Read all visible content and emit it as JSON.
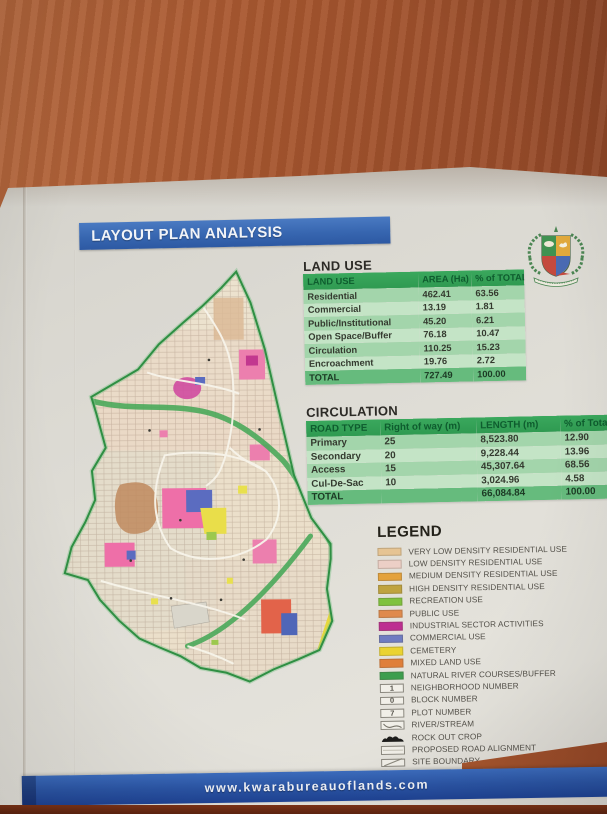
{
  "page": {
    "title_bar": {
      "label": "LAYOUT PLAN ANALYSIS",
      "bg": "#3766b0"
    },
    "footer": {
      "url": "www.kwarabureauoflands.com",
      "bg": "#2b55a5"
    },
    "table_header_green": "#34a356",
    "table_total_green": "#66bb7d"
  },
  "land_use": {
    "heading": "LAND USE",
    "columns": [
      "LAND USE",
      "AREA (Ha)",
      "% of TOTAL"
    ],
    "rows": [
      [
        "Residential",
        "462.41",
        "63.56"
      ],
      [
        "Commercial",
        "13.19",
        "1.81"
      ],
      [
        "Public/Institutional",
        "45.20",
        "6.21"
      ],
      [
        "Open Space/Buffer",
        "76.18",
        "10.47"
      ],
      [
        "Circulation",
        "110.25",
        "15.23"
      ],
      [
        "Encroachment",
        "19.76",
        "2.72"
      ],
      [
        "TOTAL",
        "727.49",
        "100.00"
      ]
    ]
  },
  "circulation": {
    "heading": "CIRCULATION",
    "columns": [
      "ROAD TYPE",
      "Right of way (m)",
      "LENGTH (m)",
      "% of Total Length"
    ],
    "rows": [
      [
        "Primary",
        "25",
        "8,523.80",
        "12.90"
      ],
      [
        "Secondary",
        "20",
        "9,228.44",
        "13.96"
      ],
      [
        "Access",
        "15",
        "45,307.64",
        "68.56"
      ],
      [
        "Cul-De-Sac",
        "10",
        "3,024.96",
        "4.58"
      ],
      [
        "TOTAL",
        "",
        "66,084.84",
        "100.00"
      ]
    ]
  },
  "legend": {
    "heading": "LEGEND",
    "items": [
      {
        "label": "VERY LOW DENSITY RESIDENTIAL USE",
        "type": "swatch",
        "color": "#e6c493",
        "icon": "very-low-density-swatch"
      },
      {
        "label": "LOW DENSITY RESIDENTIAL USE",
        "type": "swatch",
        "color": "#eccfc6",
        "icon": "low-density-swatch"
      },
      {
        "label": "MEDIUM DENSITY RESIDENTIAL USE",
        "type": "swatch",
        "color": "#e4a23c",
        "icon": "medium-density-swatch"
      },
      {
        "label": "HIGH DENSITY RESIDENTIAL USE",
        "type": "swatch",
        "color": "#bfa33f",
        "icon": "high-density-swatch"
      },
      {
        "label": "RECREATION USE",
        "type": "swatch",
        "color": "#7fc23e",
        "icon": "recreation-swatch"
      },
      {
        "label": "PUBLIC USE",
        "type": "swatch",
        "color": "#df8a4d",
        "icon": "public-use-swatch"
      },
      {
        "label": "INDUSTRIAL SECTOR ACTIVITIES",
        "type": "swatch",
        "color": "#bd2e91",
        "icon": "industrial-swatch"
      },
      {
        "label": "COMMERCIAL USE",
        "type": "swatch",
        "color": "#6f7cc2",
        "icon": "commercial-swatch"
      },
      {
        "label": "CEMETERY",
        "type": "swatch",
        "color": "#ead331",
        "icon": "cemetery-swatch"
      },
      {
        "label": "MIXED LAND USE",
        "type": "swatch",
        "color": "#df7f3a",
        "icon": "mixed-land-use-swatch"
      },
      {
        "label": "NATURAL RIVER COURSES/BUFFER",
        "type": "swatch",
        "color": "#3d9e4e",
        "icon": "river-buffer-swatch"
      },
      {
        "label": "NEIGHBORHOOD NUMBER",
        "type": "box",
        "glyph": "1",
        "icon": "neighborhood-number-symbol"
      },
      {
        "label": "BLOCK NUMBER",
        "type": "box",
        "glyph": "0",
        "icon": "block-number-symbol"
      },
      {
        "label": "PLOT NUMBER",
        "type": "box",
        "glyph": "7",
        "icon": "plot-number-symbol"
      },
      {
        "label": "RIVER/STREAM",
        "type": "river",
        "icon": "river-stream-symbol"
      },
      {
        "label": "ROCK OUT CROP",
        "type": "rock",
        "icon": "rock-outcrop-symbol"
      },
      {
        "label": "PROPOSED ROAD ALIGNMENT",
        "type": "road",
        "icon": "proposed-road-symbol"
      },
      {
        "label": "SITE BOUNDARY",
        "type": "boundary",
        "icon": "site-boundary-symbol"
      }
    ]
  }
}
